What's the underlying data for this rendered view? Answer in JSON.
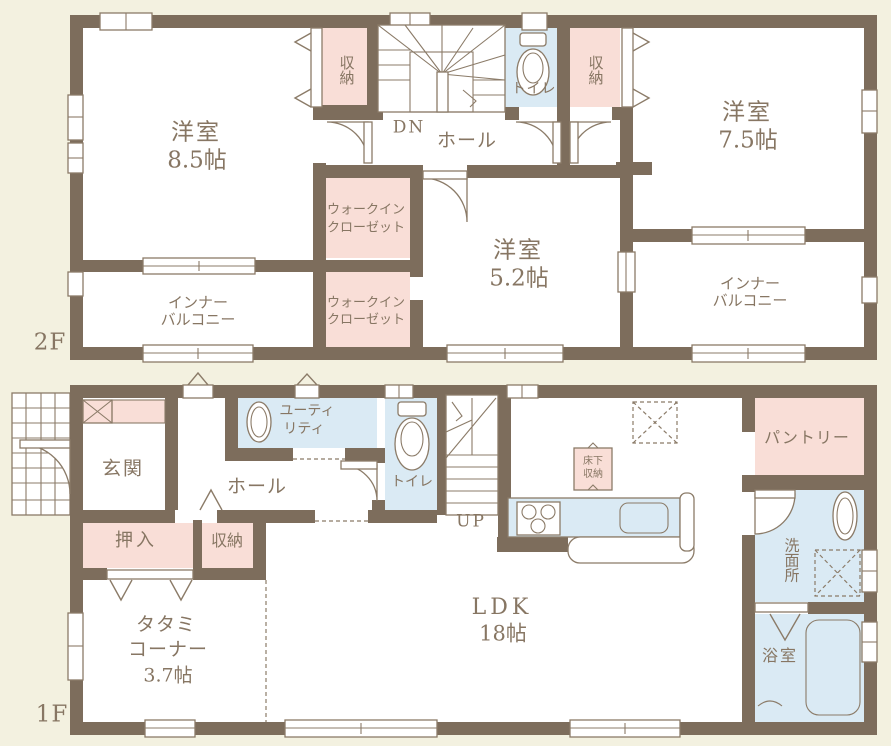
{
  "f2": {
    "label": "2F",
    "room85": [
      "洋室",
      "8.5帖"
    ],
    "room75": [
      "洋室",
      "7.5帖"
    ],
    "room52": [
      "洋室",
      "5.2帖"
    ],
    "closet": "収納",
    "toilet": "トイレ",
    "hall": "ホール",
    "dn": "DN",
    "wic": [
      "ウォークイン",
      "クローゼット"
    ],
    "balcony": [
      "インナー",
      "バルコニー"
    ]
  },
  "f1": {
    "label": "1F",
    "entrance": "玄関",
    "hall": "ホール",
    "utility": [
      "ユーティ",
      "リティ"
    ],
    "toilet": "トイレ",
    "up": "UP",
    "floor_storage": [
      "床下",
      "収納"
    ],
    "pantry": "パントリー",
    "washroom": "洗面所",
    "bath": "浴室",
    "oshiire": "押入",
    "closet": "収納",
    "tatami": [
      "タタミ",
      "コーナー",
      "3.7帖"
    ],
    "ldk": [
      "LDK",
      "18帖"
    ]
  },
  "colors": {
    "bg": "#f3f1e0",
    "wall": "#7d6d5c",
    "pink": "#f9ded7",
    "blue": "#daeaf4",
    "line": "#8b7b68",
    "text": "#877663"
  }
}
